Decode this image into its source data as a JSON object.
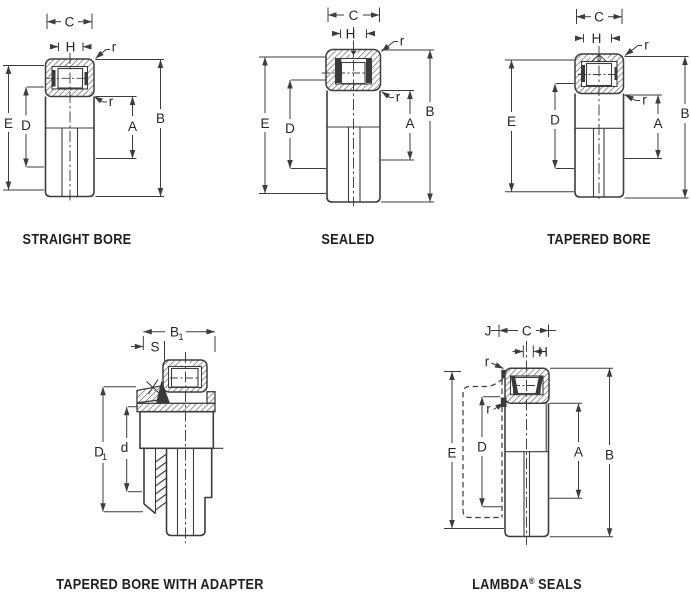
{
  "page": {
    "background": "#ffffff",
    "line_color": "#3d3d3d",
    "hatch_color": "#4f4f4f",
    "text_color": "#262626"
  },
  "diagrams": [
    {
      "id": "straight-bore",
      "caption": "STRAIGHT BORE",
      "labels": {
        "c": "C",
        "h": "H",
        "r_top": "r",
        "r_bottom": "r",
        "e": "E",
        "d": "D",
        "a": "A",
        "b": "B"
      }
    },
    {
      "id": "sealed",
      "caption": "SEALED",
      "labels": {
        "c": "C",
        "h": "H",
        "r_top": "r",
        "r_bottom": "r",
        "e": "E",
        "d": "D",
        "a": "A",
        "b": "B"
      }
    },
    {
      "id": "tapered-bore",
      "caption": "TAPERED BORE",
      "labels": {
        "c": "C",
        "h": "H",
        "r_top": "r",
        "r_bottom": "r",
        "e": "E",
        "d": "D",
        "a": "A",
        "b": "B"
      }
    },
    {
      "id": "tapered-bore-with-adapter",
      "caption": "TAPERED BORE WITH ADAPTER",
      "labels": {
        "b1_base": "B",
        "b1_sub": "1",
        "s": "S",
        "d1_base": "D",
        "d1_sub": "1",
        "d_lower": "d"
      }
    },
    {
      "id": "lambda-seals",
      "caption_parts": {
        "brand": "LAMBDA",
        "registered": "®",
        "rest": "SEALS"
      },
      "labels": {
        "j": "J",
        "c": "C",
        "h": "H",
        "r_top": "r",
        "r_bottom": "r",
        "e": "E",
        "d": "D",
        "a": "A",
        "b": "B"
      }
    }
  ]
}
